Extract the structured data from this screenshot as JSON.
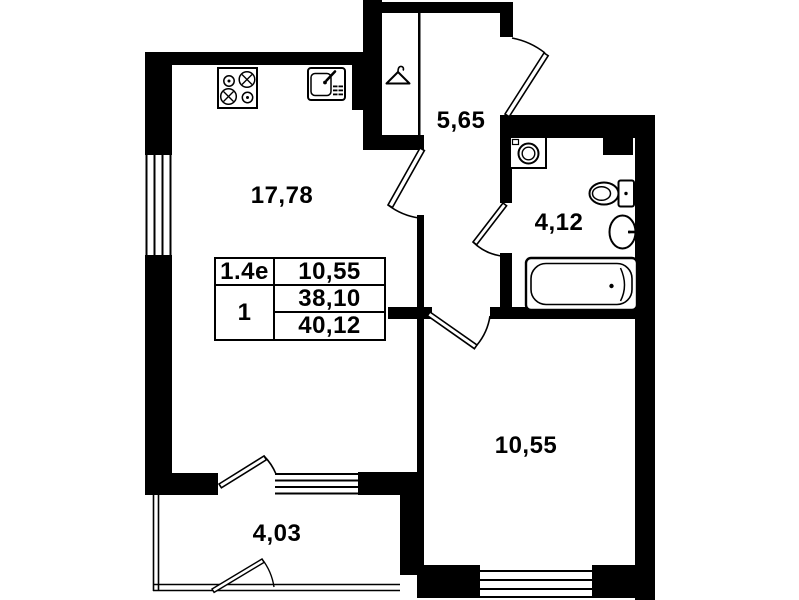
{
  "plan_title": "apartment-floor-plan",
  "colors": {
    "background": "#ffffff",
    "ink": "#000000"
  },
  "rooms": {
    "living_kitchen": {
      "area": "17,78"
    },
    "hallway": {
      "area": "5,65"
    },
    "bathroom": {
      "area": "4,12"
    },
    "bedroom": {
      "area": "10,55"
    },
    "balcony": {
      "area": "4,03"
    }
  },
  "info_table": {
    "type_cell": "1.4е",
    "top_right": "10,55",
    "unit_cell": "1",
    "mid_right": "38,10",
    "bottom_right": "40,12"
  },
  "fixtures": [
    "stove-icon",
    "kitchen-sink-icon",
    "wardrobe-hanger-icon",
    "washing-machine-icon",
    "toilet-icon",
    "wash-basin-icon",
    "bathtub-icon"
  ]
}
